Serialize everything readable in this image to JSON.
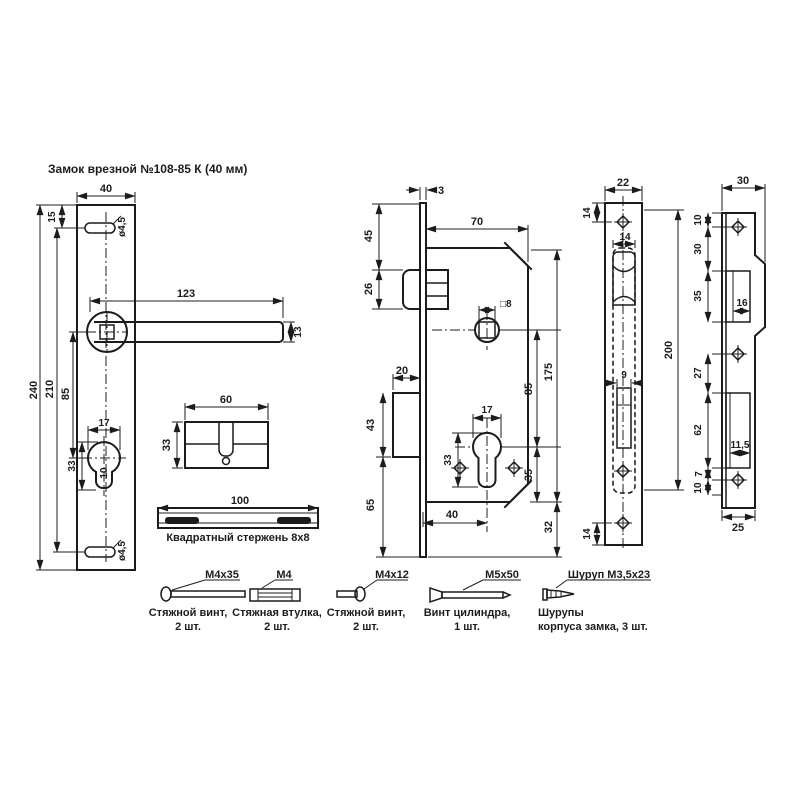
{
  "title": "Замок врезной №108-85 К (40 мм)",
  "colors": {
    "line": "#1c1c1c",
    "bg": "#ffffff"
  },
  "plate": {
    "width": "40",
    "top_offset": "15",
    "height": "240",
    "hole_span": "210",
    "centers": "85",
    "hole_dia_top": "ø4,5",
    "hole_dia_bottom": "ø4,5",
    "lever_length": "123",
    "lever_width": "13",
    "cyl_width": "17",
    "cyl_height": "33",
    "cyl_slot": "10"
  },
  "cylinder": {
    "width": "60",
    "height": "33"
  },
  "spindle": {
    "length": "100",
    "caption": "Квадратный стержень 8х8"
  },
  "body": {
    "faceplate_thk": "3",
    "top_to_latch": "45",
    "latch_h": "26",
    "width": "70",
    "spindle_sq": "□8",
    "height": "175",
    "centers": "85",
    "bolt_throw": "20",
    "bolt_h": "43",
    "bolt_to_bottom": "65",
    "cyl_w": "17",
    "cyl_h": "33",
    "cyl_to_bottom": "35",
    "backset": "40",
    "bottom_margin": "32"
  },
  "faceplate": {
    "width": "22",
    "screw_top": "14",
    "body_w": "14",
    "bolt_w": "9",
    "length": "200",
    "screw_bottom": "14"
  },
  "strike": {
    "width_top": "30",
    "screw_top": "10",
    "to_latch": "30",
    "latch_h": "35",
    "latch_w": "16",
    "screw_to_bolt": "27",
    "bolt_h": "62",
    "bolt_w": "11,5",
    "gap": "7",
    "screw_bottom": "10",
    "width_bottom": "25"
  },
  "fasteners": [
    {
      "label": "М4х35",
      "line1": "Стяжной винт,",
      "line2": "2 шт."
    },
    {
      "label": "М4",
      "line1": "Стяжная втулка,",
      "line2": "2 шт."
    },
    {
      "label": "М4х12",
      "line1": "Стяжной винт,",
      "line2": "2 шт."
    },
    {
      "label": "М5х50",
      "line1": "Винт цилиндра,",
      "line2": "1 шт."
    },
    {
      "label": "Шуруп М3,5х23",
      "line1": "Шурупы",
      "line2": "корпуса замка, 3 шт."
    }
  ]
}
